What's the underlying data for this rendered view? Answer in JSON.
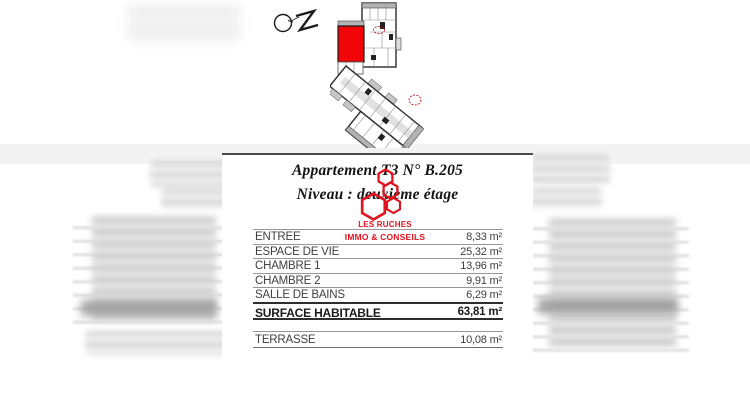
{
  "document": {
    "title_line1": "Appartement T3 N° B.205",
    "title_line2": "Niveau : deuxième étage",
    "logo": {
      "line1": "LES RUCHES",
      "line2": "IMMO & CONSEILS"
    },
    "areas": {
      "rows": [
        {
          "label": "ENTREE",
          "value": "8,33 m²"
        },
        {
          "label": "ESPACE DE VIE",
          "value": "25,32 m²"
        },
        {
          "label": "CHAMBRE 1",
          "value": "13,96 m²"
        },
        {
          "label": "CHAMBRE 2",
          "value": "9,91 m²"
        },
        {
          "label": "SALLE DE BAINS",
          "value": "6,29 m²"
        }
      ],
      "total": {
        "label": "SURFACE HABITABLE",
        "value": "63,81 m²"
      },
      "terrace": {
        "label": "TERRASSE",
        "value": "10,08 m²"
      }
    }
  },
  "colors": {
    "highlight_red": "#f20509",
    "brand_red": "#e0131f"
  }
}
